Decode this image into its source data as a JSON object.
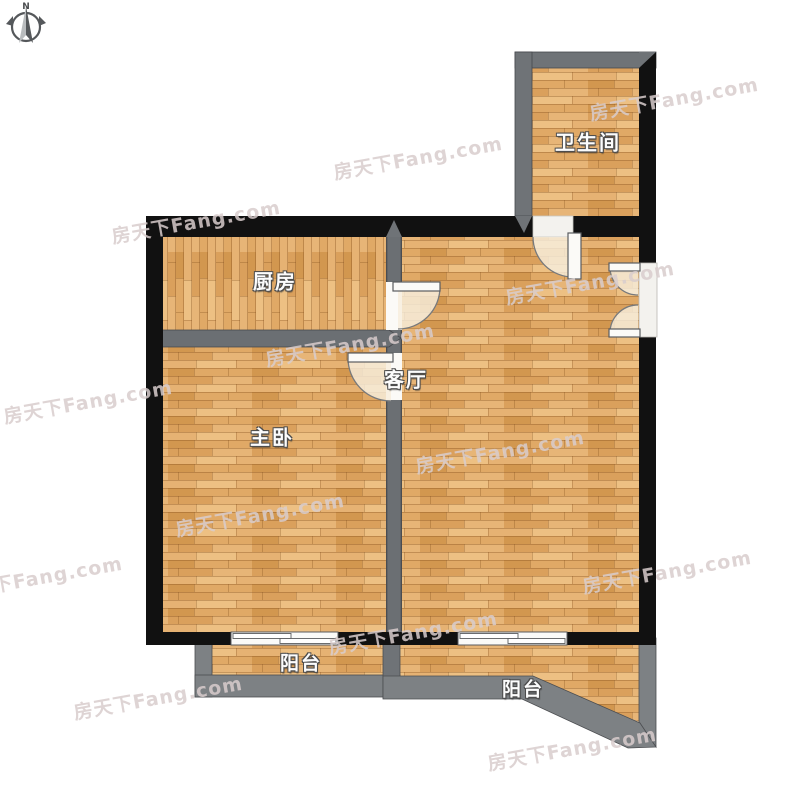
{
  "compass": {
    "north_label": "N"
  },
  "watermark": {
    "text": "房天下Fang.com",
    "color": "#d8cdcd"
  },
  "rooms": {
    "bathroom": {
      "label": "卫生间"
    },
    "kitchen": {
      "label": "厨房"
    },
    "living_room": {
      "label": "客厅"
    },
    "master_bedroom": {
      "label": "主卧"
    },
    "balcony_left": {
      "label": "阳台"
    },
    "balcony_right": {
      "label": "阳台"
    }
  },
  "colors": {
    "exterior_wall": "#111111",
    "partition_wall": "#6b6f73",
    "balcony_wall": "#7d8184",
    "floor_wood_base": "#e0a966",
    "door_window_white": "#fafaf8",
    "label_text": "#fcfcfc"
  }
}
